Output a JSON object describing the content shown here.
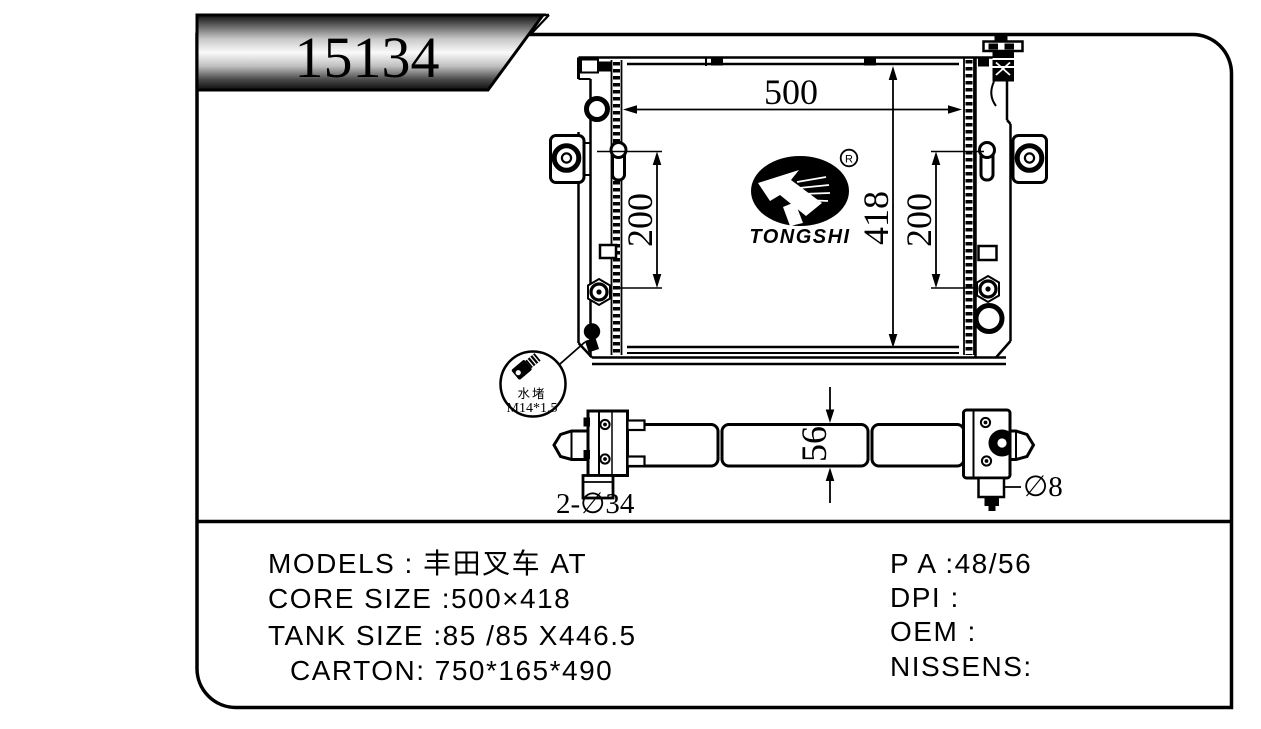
{
  "page": {
    "background": "#ffffff",
    "line_color": "#000000",
    "banner_gradient_mid": "#fafafa"
  },
  "banner": {
    "part_number": "15134"
  },
  "logo": {
    "brand": "TONGSHI",
    "registered_mark": "R"
  },
  "front_view": {
    "width_dim": "500",
    "height_dim": "418",
    "left_mount_pitch_dim": "200",
    "right_mount_pitch_dim": "200",
    "detail_callout": {
      "name_cn": "水堵",
      "thread_spec": "M14*1.5"
    }
  },
  "bottom_view": {
    "thickness_dim": "56",
    "pipe_holes_label": "2-∅34",
    "pin_hole_label": "∅8"
  },
  "spec_table": {
    "left_rows": [
      "MODELS :  丰田叉车 AT",
      "CORE SIZE :500×418",
      "TANK SIZE :85 /85 X446.5",
      "CARTON: 750*165*490"
    ],
    "right_rows": [
      "P A :48/56",
      "DPI :",
      "OEM :",
      "NISSENS:"
    ]
  }
}
